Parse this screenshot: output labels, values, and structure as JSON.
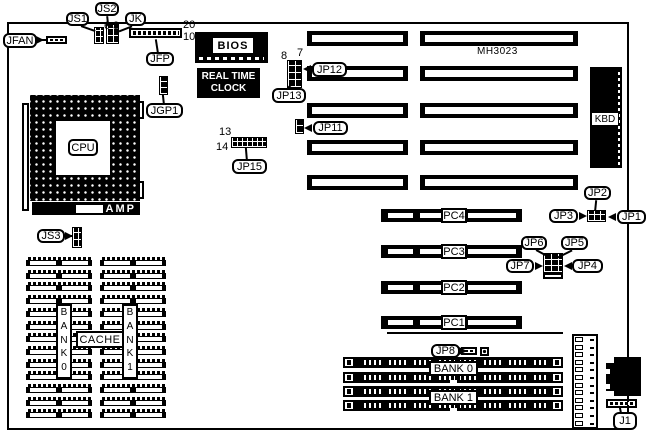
{
  "diagram_title": "motherboard-layout-diagram",
  "colors": {
    "ink": "#000000",
    "paper": "#ffffff"
  },
  "chips": {
    "bios": "BIOS",
    "rtc_line1": "REAL TIME",
    "rtc_line2": "CLOCK",
    "kbd": "KBD",
    "cpu": "CPU",
    "amp": "AMP",
    "board_id": "MH3023",
    "cache": "CACHE"
  },
  "memory": {
    "bank0": "BANK 0",
    "bank1": "BANK 1",
    "col_x": [
      26,
      100
    ],
    "col_w": 66,
    "top": 257,
    "rows": 13,
    "row_h": 9,
    "row_step": 12.7
  },
  "isa": {
    "rows": [
      31,
      66,
      103,
      140,
      175
    ],
    "h": 15,
    "left": {
      "x": 307,
      "w": 101
    },
    "right": {
      "x": 420,
      "w": 158
    }
  },
  "pci": {
    "x": 381,
    "w": 141,
    "h": 13,
    "slots": [
      {
        "label": "PC4",
        "y": 209
      },
      {
        "label": "PC3",
        "y": 245
      },
      {
        "label": "PC2",
        "y": 281
      },
      {
        "label": "PC1",
        "y": 316
      }
    ]
  },
  "simm": {
    "x": 343,
    "w": 220,
    "h": 11,
    "rows": [
      357,
      372,
      386,
      400
    ],
    "banks": [
      {
        "label": "BANK 0",
        "x": 429,
        "y": 361,
        "w": 49,
        "h": 15
      },
      {
        "label": "BANK 1",
        "x": 429,
        "y": 390,
        "w": 49,
        "h": 15
      }
    ]
  },
  "callouts": [
    {
      "name": "jfan",
      "text": "JFAN",
      "x": 3,
      "y": 33,
      "w": 34,
      "h": 15
    },
    {
      "name": "js1",
      "text": "JS1",
      "x": 66,
      "y": 12,
      "w": 23,
      "h": 14
    },
    {
      "name": "js2",
      "text": "JS2",
      "x": 95,
      "y": 2,
      "w": 24,
      "h": 14
    },
    {
      "name": "jk",
      "text": "JK",
      "x": 125,
      "y": 12,
      "w": 21,
      "h": 14
    },
    {
      "name": "jfp",
      "text": "JFP",
      "x": 146,
      "y": 52,
      "w": 28,
      "h": 14
    },
    {
      "name": "jgp1",
      "text": "JGP1",
      "x": 146,
      "y": 103,
      "w": 37,
      "h": 15
    },
    {
      "name": "jp15",
      "text": "JP15",
      "x": 232,
      "y": 159,
      "w": 35,
      "h": 15
    },
    {
      "name": "jp13",
      "text": "JP13",
      "x": 272,
      "y": 88,
      "w": 34,
      "h": 15
    },
    {
      "name": "jp12",
      "text": "JP12",
      "x": 312,
      "y": 62,
      "w": 35,
      "h": 15
    },
    {
      "name": "jp11",
      "text": "JP11",
      "x": 313,
      "y": 121,
      "w": 35,
      "h": 14
    },
    {
      "name": "js3",
      "text": "JS3",
      "x": 37,
      "y": 229,
      "w": 28,
      "h": 14
    },
    {
      "name": "jp2",
      "text": "JP2",
      "x": 584,
      "y": 186,
      "w": 27,
      "h": 14
    },
    {
      "name": "jp3",
      "text": "JP3",
      "x": 549,
      "y": 209,
      "w": 29,
      "h": 14
    },
    {
      "name": "jp1",
      "text": "JP1",
      "x": 617,
      "y": 210,
      "w": 29,
      "h": 14
    },
    {
      "name": "jp6",
      "text": "JP6",
      "x": 521,
      "y": 236,
      "w": 26,
      "h": 14
    },
    {
      "name": "jp5",
      "text": "JP5",
      "x": 561,
      "y": 236,
      "w": 27,
      "h": 14
    },
    {
      "name": "jp7",
      "text": "JP7",
      "x": 506,
      "y": 259,
      "w": 28,
      "h": 14
    },
    {
      "name": "jp4",
      "text": "JP4",
      "x": 572,
      "y": 259,
      "w": 31,
      "h": 14
    },
    {
      "name": "jp8",
      "text": "JP8",
      "x": 431,
      "y": 344,
      "w": 29,
      "h": 14
    },
    {
      "name": "j1",
      "text": "J1",
      "x": 613,
      "y": 412,
      "w": 24,
      "h": 18
    }
  ],
  "pin_labels": [
    {
      "text": "20",
      "x": 183,
      "y": 19
    },
    {
      "text": "10",
      "x": 183,
      "y": 31
    },
    {
      "text": "6",
      "x": 104,
      "y": 20
    },
    {
      "text": "3",
      "x": 113,
      "y": 20
    },
    {
      "text": "8",
      "x": 281,
      "y": 50
    },
    {
      "text": "7",
      "x": 297,
      "y": 47
    },
    {
      "text": "13",
      "x": 219,
      "y": 126
    },
    {
      "text": "14",
      "x": 216,
      "y": 141
    }
  ],
  "jumpers": [
    {
      "name": "jfan-connector",
      "x": 46,
      "y": 36,
      "w": 21,
      "h": 8,
      "type": "ticks"
    },
    {
      "name": "js1-jumper",
      "x": 94,
      "y": 27,
      "w": 10,
      "h": 17,
      "type": "grid",
      "cx": 5,
      "cy": 6
    },
    {
      "name": "jk-jumper",
      "x": 106,
      "y": 24,
      "w": 13,
      "h": 20,
      "type": "grid",
      "cx": 6,
      "cy": 7
    },
    {
      "name": "jfp-header",
      "x": 129,
      "y": 28,
      "w": 53,
      "h": 10,
      "type": "ticks"
    },
    {
      "name": "jgp1-jumper",
      "x": 159,
      "y": 76,
      "w": 9,
      "h": 19,
      "type": "grid",
      "cx": 8,
      "cy": 6
    },
    {
      "name": "jp15-block",
      "x": 231,
      "y": 137,
      "w": 36,
      "h": 11,
      "type": "grid",
      "cx": 5,
      "cy": 5
    },
    {
      "name": "jp12-jp13-block",
      "x": 287,
      "y": 60,
      "w": 15,
      "h": 28,
      "type": "grid",
      "cx": 7,
      "cy": 7
    },
    {
      "name": "jp11-jumper",
      "x": 295,
      "y": 119,
      "w": 9,
      "h": 15,
      "type": "grid",
      "cx": 8,
      "cy": 7
    },
    {
      "name": "js3-jumper",
      "x": 72,
      "y": 227,
      "w": 10,
      "h": 21,
      "type": "grid",
      "cx": 5,
      "cy": 7
    },
    {
      "name": "jp1-jp2-jp3-block",
      "x": 587,
      "y": 210,
      "w": 19,
      "h": 12,
      "type": "grid",
      "cx": 6,
      "cy": 6
    },
    {
      "name": "jp4-jp5-jp6-jp7-block",
      "x": 543,
      "y": 253,
      "w": 20,
      "h": 20,
      "type": "grid",
      "cx": 7,
      "cy": 6
    },
    {
      "name": "jp4-jp5-jp6-jp7-pins",
      "x": 543,
      "y": 273,
      "w": 20,
      "h": 6,
      "type": "ticks"
    },
    {
      "name": "jp8-connector",
      "x": 461,
      "y": 347,
      "w": 16,
      "h": 8,
      "type": "ticks"
    },
    {
      "name": "jp8-pad",
      "x": 480,
      "y": 347,
      "w": 9,
      "h": 9,
      "type": "pad"
    },
    {
      "name": "j1-connector",
      "x": 606,
      "y": 399,
      "w": 31,
      "h": 9,
      "type": "ticks"
    }
  ],
  "pointers": [
    [
      81,
      26,
      95,
      31
    ],
    [
      107,
      16,
      108,
      26
    ],
    [
      132,
      26,
      119,
      31
    ],
    [
      158,
      52,
      156,
      39
    ],
    [
      164,
      103,
      163,
      94
    ],
    [
      247,
      159,
      246,
      147
    ],
    [
      288,
      88,
      293,
      83
    ],
    [
      596,
      200,
      595,
      210
    ],
    [
      536,
      250,
      547,
      256
    ],
    [
      572,
      250,
      558,
      257
    ],
    [
      621,
      412,
      620,
      407
    ],
    [
      40,
      40,
      47,
      40
    ],
    [
      68,
      236,
      73,
      236
    ],
    [
      462,
      351,
      468,
      351
    ]
  ],
  "arrows": [
    {
      "x": 36,
      "y": 36,
      "dir": "r"
    },
    {
      "x": 65,
      "y": 232,
      "dir": "r"
    },
    {
      "x": 303,
      "y": 65,
      "dir": "l"
    },
    {
      "x": 304,
      "y": 124,
      "dir": "l"
    },
    {
      "x": 579,
      "y": 212,
      "dir": "r"
    },
    {
      "x": 608,
      "y": 213,
      "dir": "l"
    },
    {
      "x": 535,
      "y": 262,
      "dir": "r"
    },
    {
      "x": 564,
      "y": 262,
      "dir": "l"
    },
    {
      "x": 459,
      "y": 347,
      "dir": "r"
    }
  ]
}
